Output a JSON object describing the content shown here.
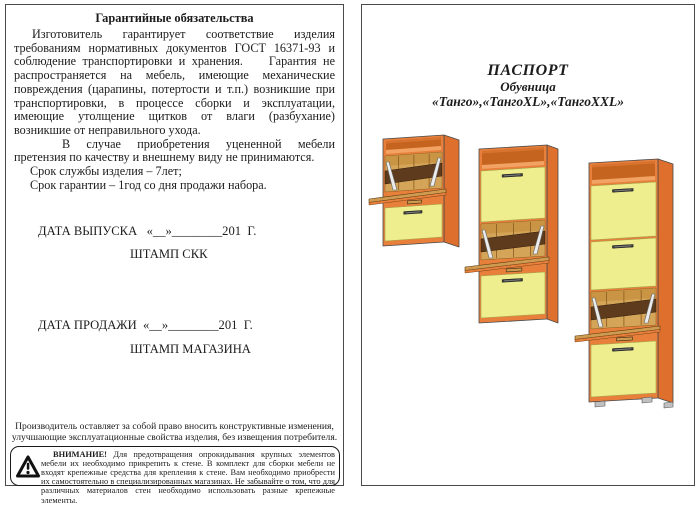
{
  "left": {
    "title": "Гарантийные обязательства",
    "para1": "Изготовитель гарантирует соответствие изделия требованиям нормативных документов ГОСТ 16371-93 и соблюдение транспортировки и хранения.    Гарантия не распространяется на мебель, имеющие механические повреждения (царапины, потертости и т.п.) возникшие при транспортировки, в процессе сборки и эксплуатации, имеющие утолщение щитков от влаги (разбухание) возникшие от неправильного ухода.",
    "para2": "В случае приобретения уцененной мебели претензия по качеству и внешнему виду не принимаются.",
    "term_service": "Срок службы изделия – 7лет;",
    "term_warranty": "Срок гарантии – 1год со дня продажи набора.",
    "date_issue": "ДАТА ВЫПУСКА   «__»________201  Г.",
    "stamp_skk": "ШТАМП СКК",
    "date_sale": "ДАТА ПРОДАЖИ  «__»________201  Г.",
    "stamp_shop": "ШТАМП МАГАЗИНА",
    "note": "Производитель оставляет за собой право вносить конструктивные изменения, улучшающие эксплуатационные свойства изделия, без извещения потребителя.",
    "warning_title": "ВНИМАНИЕ!",
    "warning_body": "Для предотвращения опрокидывания крупных элементов мебели их необходимо прикрепить к стене. В комплект для сборки мебели не входят крепежные средства для крепления к стене. Вам необходимо приобрести их самостоятельно в специализированных магазинах. Не забывайте о том, что для различных материалов стен необходимо использовать разные крепежные элементы."
  },
  "right": {
    "title": "ПАСПОРТ",
    "subtitle": "Обувница",
    "models": "«Танго»,«ТангоXL»,«ТангоXXL»",
    "colors": {
      "body": "#e8803c",
      "side": "#de6f2d",
      "niche": "#c4641f",
      "niche_floor": "#f2a262",
      "front": "#eeee8e",
      "front_edge": "#a3a34a",
      "interior": "#d4a558",
      "interior_dark": "#c08937",
      "band": "#5e3b1c",
      "board": "#cf9b50",
      "handle": "#3a3a3a",
      "metal": "#ececec",
      "outline": "#4a4a4a",
      "foot": "#c0c0c0"
    },
    "cabinets": [
      {
        "name": "Танго",
        "x": 21,
        "y": 134,
        "width": 61,
        "height": 107,
        "depth": 15,
        "drop": 5,
        "tilt": 4,
        "sections": [
          {
            "type": "niche",
            "h": 16
          },
          {
            "type": "open",
            "h": 46
          },
          {
            "type": "vent",
            "h": 6
          },
          {
            "type": "closed",
            "h": 35
          }
        ]
      },
      {
        "name": "ТангоXL",
        "x": 117,
        "y": 144,
        "width": 68,
        "height": 174,
        "depth": 11,
        "drop": 4,
        "tilt": 4,
        "sections": [
          {
            "type": "niche",
            "h": 21
          },
          {
            "type": "closed",
            "h": 53
          },
          {
            "type": "open",
            "h": 46
          },
          {
            "type": "vent",
            "h": 6
          },
          {
            "type": "closed",
            "h": 44
          }
        ]
      },
      {
        "name": "ТангоXXL",
        "x": 227,
        "y": 158,
        "width": 69,
        "height": 239,
        "depth": 15,
        "drop": 5,
        "tilt": 4,
        "feet": true,
        "sections": [
          {
            "type": "niche",
            "h": 22
          },
          {
            "type": "closed",
            "h": 56
          },
          {
            "type": "closed",
            "h": 50
          },
          {
            "type": "open",
            "h": 47
          },
          {
            "type": "vent",
            "h": 6
          },
          {
            "type": "closed",
            "h": 54
          }
        ]
      }
    ]
  }
}
